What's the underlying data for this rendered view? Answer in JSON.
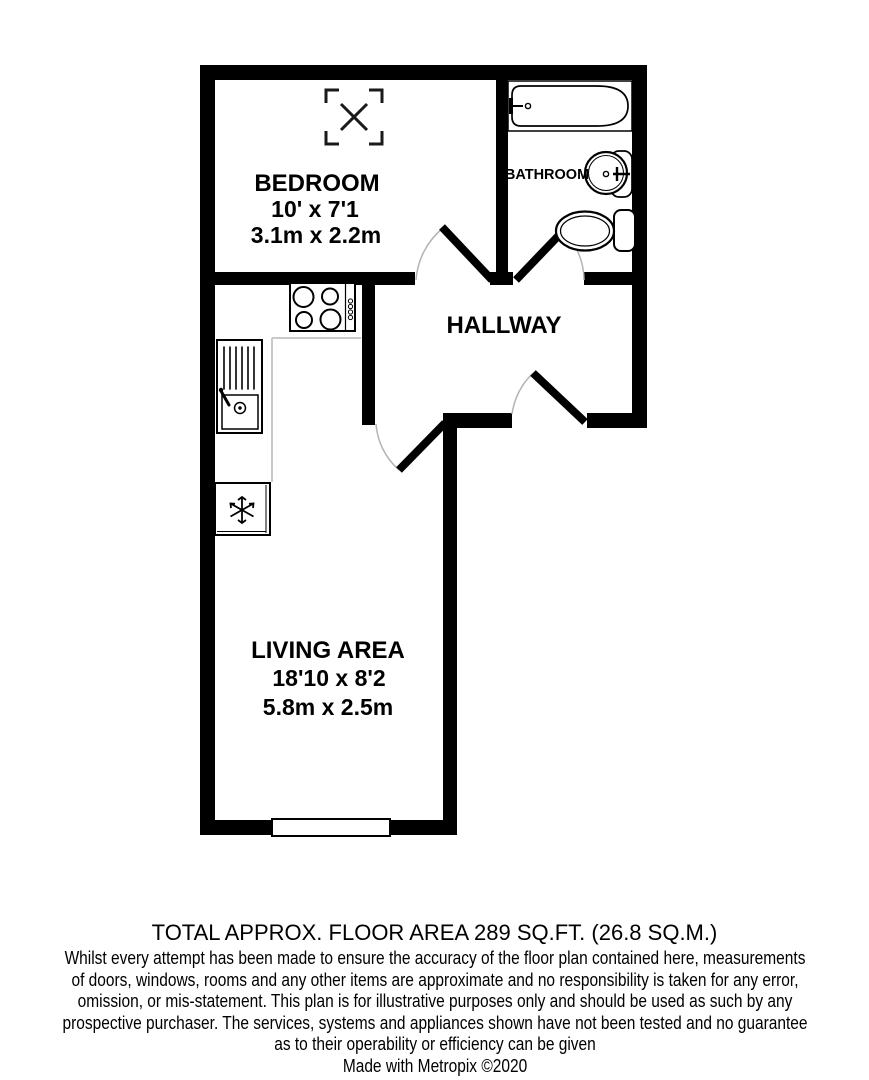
{
  "rooms": {
    "bedroom": {
      "label": "BEDROOM",
      "imperial": "10' x 7'1",
      "metric": "3.1m x 2.2m"
    },
    "bathroom": {
      "label": "BATHROOM"
    },
    "hallway": {
      "label": "HALLWAY"
    },
    "living": {
      "label": "LIVING AREA",
      "imperial": "18'10 x 8'2",
      "metric": "5.8m x 2.5m"
    }
  },
  "footer": {
    "total_area": "TOTAL APPROX. FLOOR AREA 289 SQ.FT. (26.8 SQ.M.)",
    "disclaimer_lines": [
      "Whilst every attempt has been made to ensure the accuracy of the floor plan contained here, measurements",
      "of doors, windows, rooms and any other items are approximate and no responsibility is taken for any error,",
      "omission, or mis-statement. This plan is for illustrative purposes only and should be used as such by any",
      "prospective purchaser. The services, systems and appliances shown have not been tested and no guarantee",
      "as to their operability or efficiency can be given"
    ],
    "credit": "Made with Metropix ©2020"
  },
  "icons": {
    "skylight_window": "square-corner-arrows-with-x",
    "bathtub": "bathtub-outline",
    "basin": "round-pedestal-basin",
    "toilet": "toilet-with-cistern",
    "hob": "four-burner-hob",
    "kitchen_sink": "sink-with-drainer-and-tap",
    "fridge": "snowflake",
    "window": "white-wall-window",
    "door": "quarter-circle-door-swing"
  },
  "colors": {
    "wall": "#000000",
    "door_arc": "#b3b3b3",
    "counter_edge": "#c9c9c9",
    "background": "#ffffff",
    "fixture_stroke": "#000000"
  }
}
